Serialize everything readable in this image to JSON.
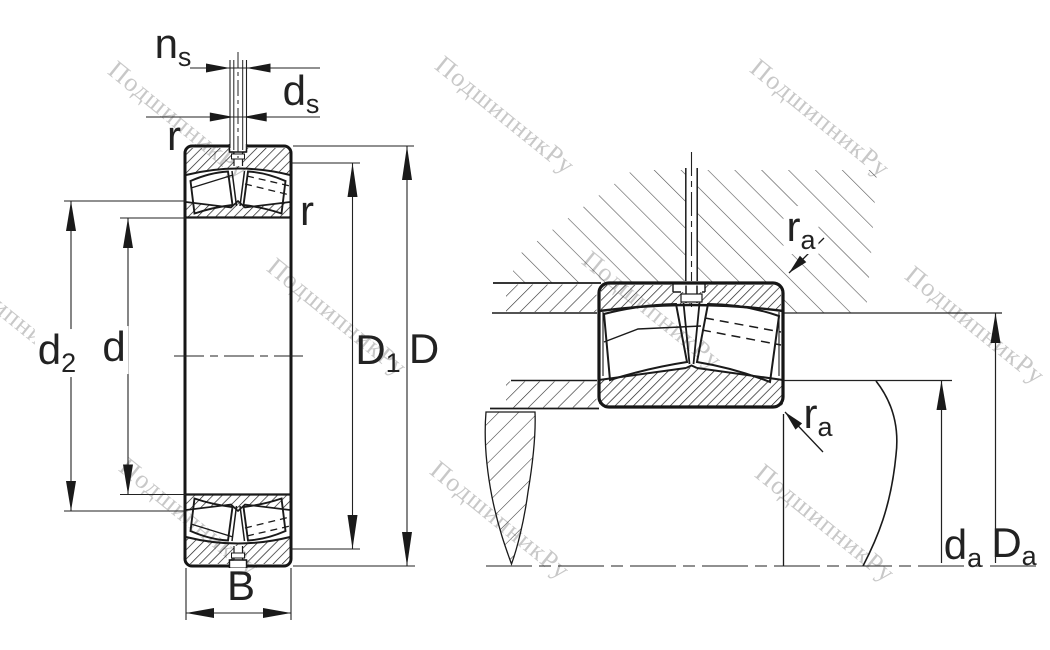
{
  "watermark": {
    "text": "ПодшипникРу",
    "color": "#c8c8c8"
  },
  "drawing": {
    "background": "#ffffff",
    "line_color": "#1a1a1a",
    "hatch_color": "#2a2a2a",
    "housing_hatch_color": "#555555"
  },
  "left_view": {
    "name": "bearing-cross-section",
    "labels": {
      "ns": {
        "main": "n",
        "sub": "s"
      },
      "ds": {
        "main": "d",
        "sub": "s"
      },
      "r_top": {
        "main": "r",
        "sub": ""
      },
      "r_side": {
        "main": "r",
        "sub": ""
      },
      "d2": {
        "main": "d",
        "sub": "2"
      },
      "d": {
        "main": "d",
        "sub": ""
      },
      "D1": {
        "main": "D",
        "sub": "1"
      },
      "D": {
        "main": "D",
        "sub": ""
      },
      "B": {
        "main": "B",
        "sub": ""
      }
    }
  },
  "right_view": {
    "name": "mounting-arrangement",
    "labels": {
      "ra_top": {
        "main": "r",
        "sub": "a"
      },
      "ra_bottom": {
        "main": "r",
        "sub": "a"
      },
      "da": {
        "main": "d",
        "sub": "a"
      },
      "Da": {
        "main": "D",
        "sub": "a"
      }
    }
  }
}
